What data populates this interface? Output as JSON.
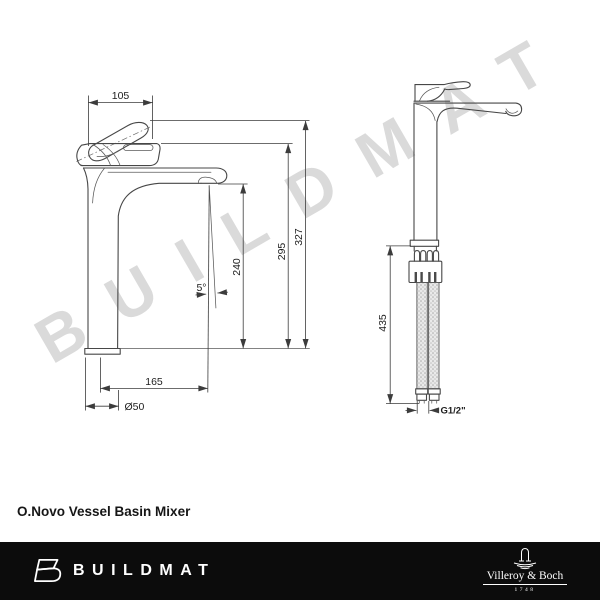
{
  "watermark": "BUILDMAT",
  "title": "O.Novo Vessel Basin Mixer",
  "drawing": {
    "front_view": {
      "dims": {
        "handle_width": "105",
        "overall_height": "327",
        "spout_height": "295",
        "outlet_height": "240",
        "spout_angle": "5°",
        "spout_reach": "165",
        "base_diameter": "Ø50"
      }
    },
    "side_view": {
      "dims": {
        "hose_length": "435",
        "connection_thread": "G1/2\""
      }
    }
  },
  "footer": {
    "buildmat_wordmark": "BUILDMAT",
    "brand_name": "Villeroy & Boch",
    "brand_year": "1748"
  },
  "colors": {
    "line": "#474747",
    "dimension_text": "#1d1d1d",
    "watermark": "#dadada",
    "footer_background": "#0c0c0c",
    "footer_text": "#ffffff"
  }
}
